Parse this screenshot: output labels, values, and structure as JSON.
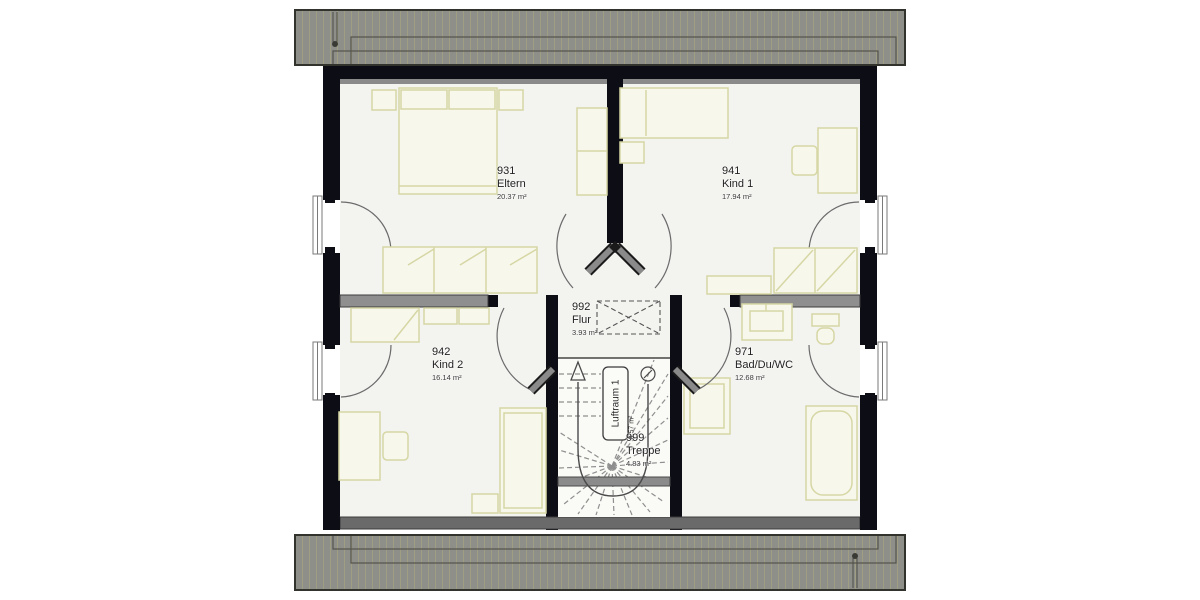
{
  "plan": {
    "title": "Dachgeschoss Grundriss",
    "rooms": {
      "eltern": {
        "number": "931",
        "name": "Eltern",
        "area": "20.37 m²"
      },
      "kind1": {
        "number": "941",
        "name": "Kind 1",
        "area": "17.94 m²"
      },
      "kind2": {
        "number": "942",
        "name": "Kind 2",
        "area": "16.14 m²"
      },
      "bad": {
        "number": "971",
        "name": "Bad/Du/WC",
        "area": "12.68 m²"
      },
      "flur": {
        "number": "992",
        "name": "Flur",
        "area": "3.93 m²"
      },
      "treppe": {
        "number": "999",
        "name": "Treppe",
        "area": "4.83 m²"
      },
      "luftraum": {
        "name": "Luftraum 1",
        "area": "0.57 m²"
      }
    },
    "colors": {
      "wall": "#0d0d15",
      "interior_wall": "#8f8f8f",
      "roof": "#8f8f8a",
      "roof_hatch": "#9f9e82",
      "furniture": "#d6d7a4",
      "floor": "#f3f3f0"
    }
  }
}
